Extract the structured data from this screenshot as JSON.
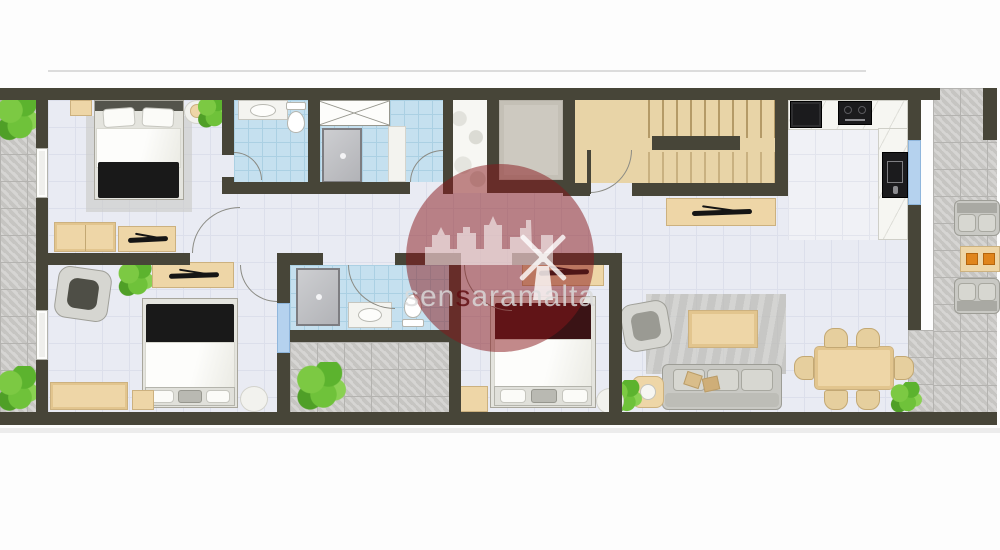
{
  "watermark": {
    "text": "sensaramalta",
    "segments": {
      "pre": "sen",
      "accent": "s",
      "post": "aramalta"
    }
  },
  "palette": {
    "wall": "#474538",
    "interior_floor_tile": "#e9ebf3",
    "bathroom_tile": "#c5e0ef",
    "terrace_tile": "#c6c5c2",
    "wood_furniture": "#eed6a7",
    "stair_wood": "#e8d4a7",
    "watermark_red": "#88161a",
    "accent_orange": "#e0851c",
    "plant_green": "#5cb32e",
    "window_blue": "#b5d2ee"
  }
}
